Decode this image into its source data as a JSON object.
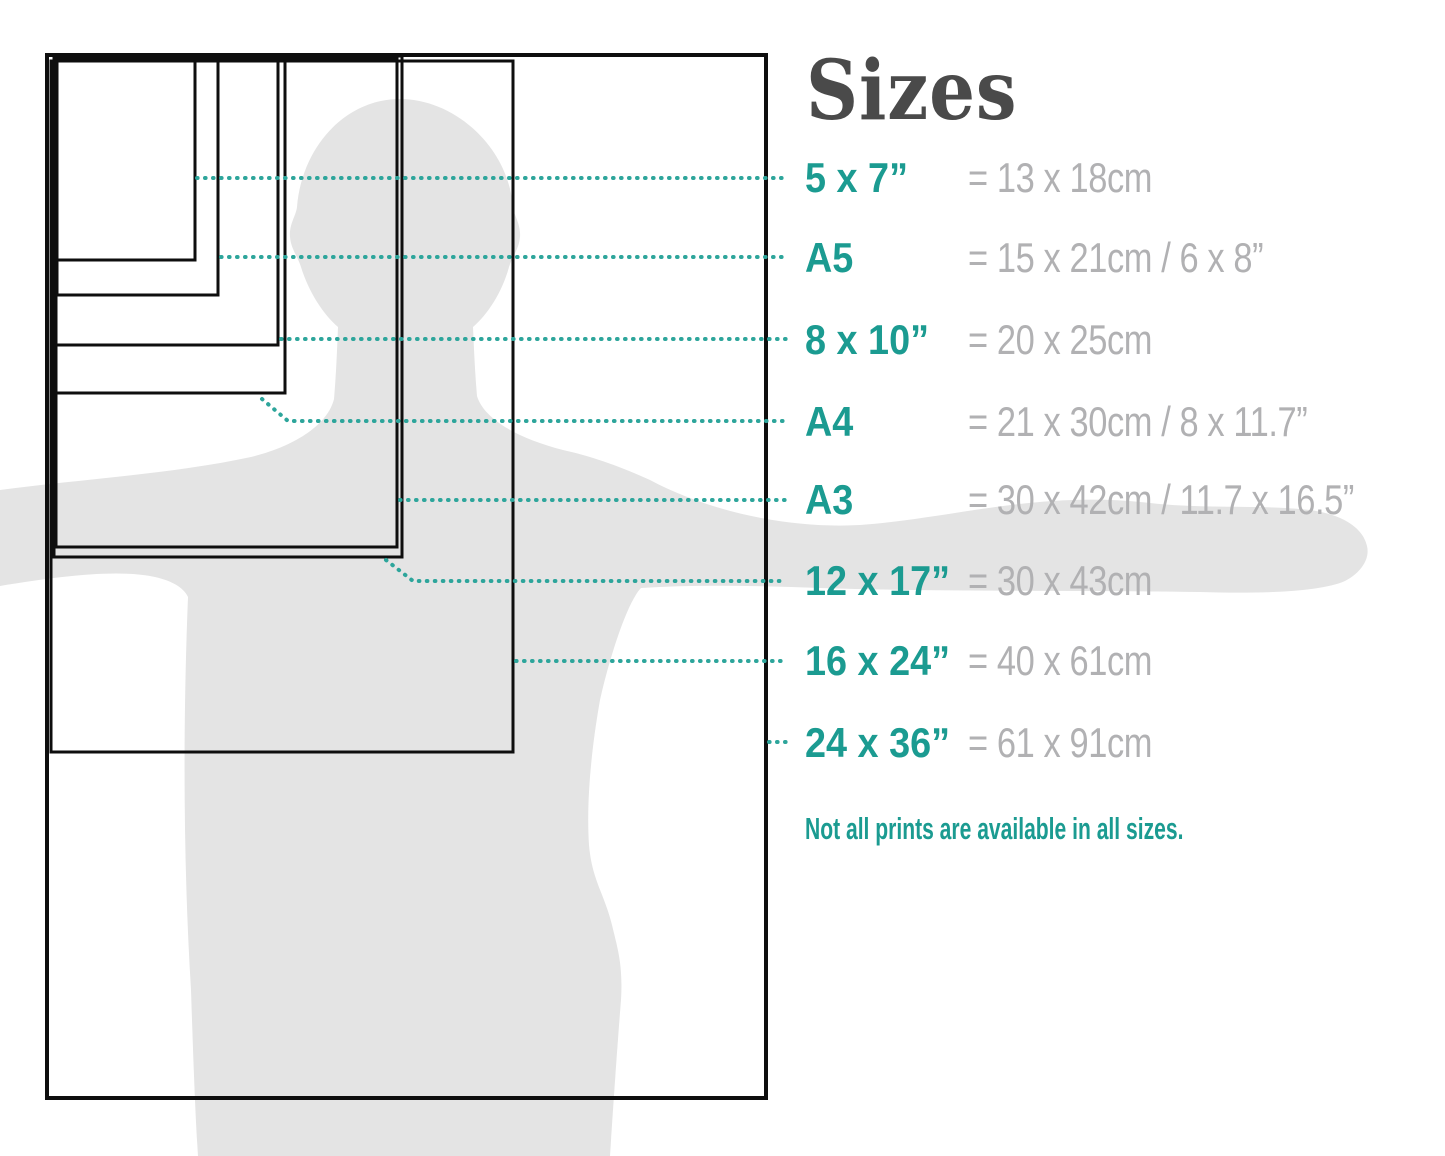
{
  "title": "Sizes",
  "note": "Not all prints are available in all sizes.",
  "sizes": [
    {
      "id": "5x7",
      "label": "5 x 7”",
      "metric": "= 13 x 18cm"
    },
    {
      "id": "a5",
      "label": "A5",
      "metric": "= 15 x 21cm / 6 x 8”"
    },
    {
      "id": "8x10",
      "label": "8 x 10”",
      "metric": "= 20 x 25cm"
    },
    {
      "id": "a4",
      "label": "A4",
      "metric": "= 21 x 30cm / 8 x 11.7”"
    },
    {
      "id": "a3",
      "label": "A3",
      "metric": "= 30 x 42cm / 11.7 x 16.5”"
    },
    {
      "id": "12x17",
      "label": "12 x 17”",
      "metric": "= 30 x 43cm"
    },
    {
      "id": "16x24",
      "label": "16 x 24”",
      "metric": "= 40 x 61cm"
    },
    {
      "id": "24x36",
      "label": "24 x 36”",
      "metric": "= 61 x 91cm"
    }
  ],
  "colors": {
    "teal": "#1b9b91",
    "teal_dots": "#2da59b",
    "metric_gray": "#b1b1b3",
    "title_gray": "#4a4a4a",
    "silhouette_gray": "#e4e4e4",
    "line_black": "#0e0e0e",
    "background": "#ffffff"
  }
}
